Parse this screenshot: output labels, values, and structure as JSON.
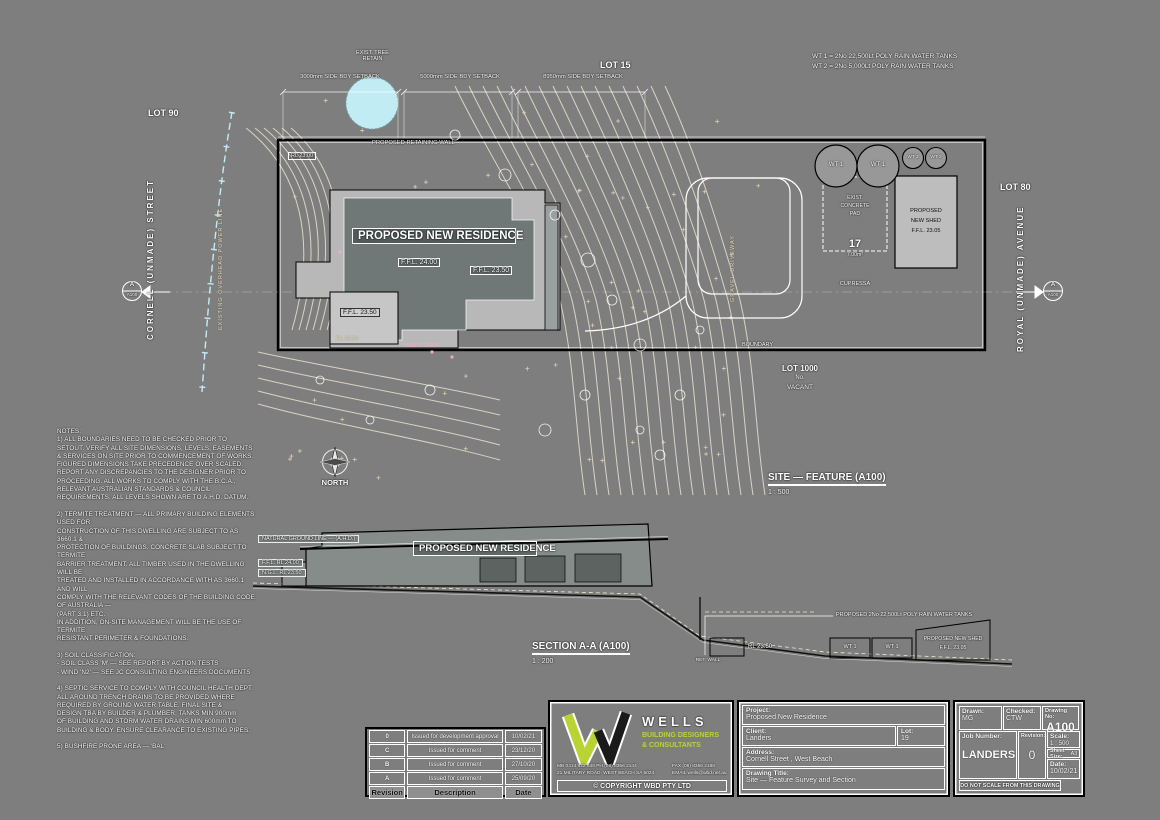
{
  "plan": {
    "lots": {
      "lot90": "LOT 90",
      "lot15": "LOT 15",
      "lot80": "LOT 80",
      "lot1000_l1": "LOT 1000",
      "lot1000_l2": "No.",
      "lot1000_l3": "VACANT"
    },
    "streets": {
      "left": "CORNELL   (UNMADE)   STREET",
      "right": "ROYAL   (UNMADE)   AVENUE"
    },
    "utility_label": "EXISTING OVERHEAD POWER LINE",
    "tank_note": {
      "line1": "WT 1 = 2No 22,500Lt POLY RAIN WATER TANKS",
      "line2": "WT 2 = 2No 5,000Lt POLY RAIN WATER TANKS"
    },
    "dims": {
      "d1": "3000mm SIDE BDY SETBACK",
      "d2": "5000mm SIDE BDY SETBACK",
      "d3": "8950mm SIDE BDY SETBACK"
    },
    "tree_note": {
      "line1": "EXIST. TREE",
      "line2": "RETAIN"
    },
    "retaining_note": "PROPOSED RETAINING WALL",
    "rl_note": "RL 23.00",
    "boundary_label": "BOUNDARY",
    "residence": {
      "label": "PROPOSED NEW RESIDENCE",
      "ffl_main": "F.F.L. 24.00",
      "ffl_right": "F.F.L. 23.50",
      "ffl_garage": "F.F.L. 23.50",
      "rl_deck": "RL 23.30",
      "deck": "TIMBER DECK"
    },
    "driveway": "GRAVEL DRIVEWAY",
    "tanks": {
      "wt1": "WT 1",
      "wt2": "WT 2"
    },
    "pad": {
      "l1": "EXIST.",
      "l2": "CONCRETE",
      "l3": "PAD",
      "num": "17",
      "area": "7.00m²",
      "species": "CUPRESSA"
    },
    "shed": {
      "l1": "PROPOSED",
      "l2": "NEW SHED",
      "l3": "F.F.L. 23.05"
    },
    "north": "NORTH",
    "section_marker": {
      "letter": "A",
      "sheet": "A100"
    }
  },
  "titles": {
    "site": "SITE — FEATURE (A100)",
    "site_scale": "1 : 500",
    "section": "SECTION A-A (A100)",
    "section_scale": "1 : 200"
  },
  "section": {
    "ground_label": "NATURAL GROUND LINE — (A.H.D.)",
    "ffl": "F.F.L.   RL 24.00",
    "ngl": "N.G.L.   RL 23.50",
    "residence_label": "PROPOSED NEW RESIDENCE",
    "tank_leader": "PROPOSED 2No 22,500Lt POLY RAIN WATER TANKS",
    "rl_mid": "RL 23.50",
    "wt1a": "WT 1",
    "wt1b": "WT 1",
    "shed_l1": "PROPOSED NEW SHED",
    "shed_l2": "F.F.L. 23.05",
    "ret_wall": "RET. WALL"
  },
  "notes": {
    "text": "NOTES:\n1) ALL BOUNDARIES NEED TO BE CHECKED PRIOR TO\nSETOUT. VERIFY ALL SITE DIMENSIONS, LEVELS, EASEMENTS\n& SERVICES ON SITE PRIOR TO COMMENCEMENT OF WORKS.\nFIGURED DIMENSIONS TAKE PRECEDENCE OVER SCALED.\nREPORT ANY DISCREPANCIES TO THE DESIGNER PRIOR TO\nPROCEEDING. ALL WORKS TO COMPLY WITH THE B.C.A.,\nRELEVANT AUSTRALIAN STANDARDS & COUNCIL\nREQUIREMENTS. ALL LEVELS SHOWN ARE TO A.H.D. DATUM.\n\n2) TERMITE TREATMENT — ALL PRIMARY BUILDING ELEMENTS USED FOR\nCONSTRUCTION OF THIS DWELLING ARE SUBJECT TO AS 3660.1 &\nPROTECTION OF BUILDINGS. CONCRETE SLAB SUBJECT TO TERMITE\nBARRIER TREATMENT. ALL TIMBER USED IN THE DWELLING WILL BE\nTREATED AND INSTALLED IN ACCORDANCE WITH AS 3660.1 AND WILL\nCOMPLY WITH THE RELEVANT CODES OF THE BUILDING CODE OF AUSTRALIA —\n(PART 3.1) ETC.\nIN ADDITION, ON-SITE MANAGEMENT WILL BE THE USE OF TERMITE\nRESISTANT PERIMETER & FOUNDATIONS.\n\n3) SOIL CLASSIFICATION:\n- SOIL CLASS 'M' — SEE REPORT BY ACTION TESTS\n- WIND 'N2' — SEE JC CONSULTING ENGINEERS DOCUMENTS\n\n4) SEPTIC SERVICE TO COMPLY WITH COUNCIL HEALTH DEPT.\nALL AROUND TRENCH DRAINS TO BE PROVIDED WHERE\nREQUIRED BY GROUND WATER TABLE. FINAL SITE &\nDESIGN TBA BY BUILDER & PLUMBER. TANKS MIN 900mm\nOF BUILDING AND STORM WATER DRAINS MIN 600mm TO\nBUILDING & BODY. ENSURE CLEARANCE TO EXISTING PIPES.\n\n5) BUSHFIRE PRONE AREA — 'BAL'"
  },
  "revision_table": {
    "headers": {
      "revision": "Revision",
      "description": "Description",
      "date": "Date"
    },
    "rows": [
      {
        "rev": "0",
        "desc": "Issued for development approval",
        "date": "10/02/21"
      },
      {
        "rev": "C",
        "desc": "Issued for comment",
        "date": "23/12/20"
      },
      {
        "rev": "B",
        "desc": "Issued for comment",
        "date": "27/10/20"
      },
      {
        "rev": "A",
        "desc": "Issued for comment",
        "date": "25/09/20"
      }
    ]
  },
  "company": {
    "name": "WELLS",
    "tagline1": "BUILDING DESIGNERS",
    "tagline2": "& CONSULTANTS",
    "contact1": "MB 0414 822 848  PH (08) 8356 2144",
    "contact2": "21 MILITARY ROAD, WEST BEACH SA 5024",
    "contact3": "FAX (08) 8356 2188",
    "contact4": "EMAIL wells@wbd.net.au",
    "copyright": "© COPYRIGHT WBD PTY LTD"
  },
  "project": {
    "project_label": "Project:",
    "project": "Proposed New Residence",
    "client_label": "Client:",
    "client": "Landers",
    "lot_label": "Lot:",
    "lot": "19",
    "address_label": "Address:",
    "address": "Cornell Street , West Beach",
    "title_label": "Drawing Title:",
    "title": "Site — Feature Survey and Section"
  },
  "titleblock": {
    "drawn_label": "Drawn:",
    "drawn": "MG",
    "checked_label": "Checked:",
    "checked": "CTW",
    "drawingno_label": "Drawing No:",
    "drawingno": "A100",
    "job_label": "Job Number:",
    "job": "LANDERS",
    "rev_label": "Revision:",
    "rev": "0",
    "scale_label": "Scale:",
    "scale": "1 : 500",
    "sheet_label": "Sheet Size:",
    "sheet": "A3",
    "date_label": "Date:",
    "date": "10/02/21",
    "warning": "DO NOT SCALE FROM THIS DRAWING"
  },
  "colors": {
    "background": "#7e7e7e",
    "linework": "#ffffff",
    "ink": "#000000",
    "contour": "#f3ecd9",
    "water": "#c2ecf4",
    "logo_green": "#b9d334",
    "deck_pink": "#efa9c8"
  }
}
